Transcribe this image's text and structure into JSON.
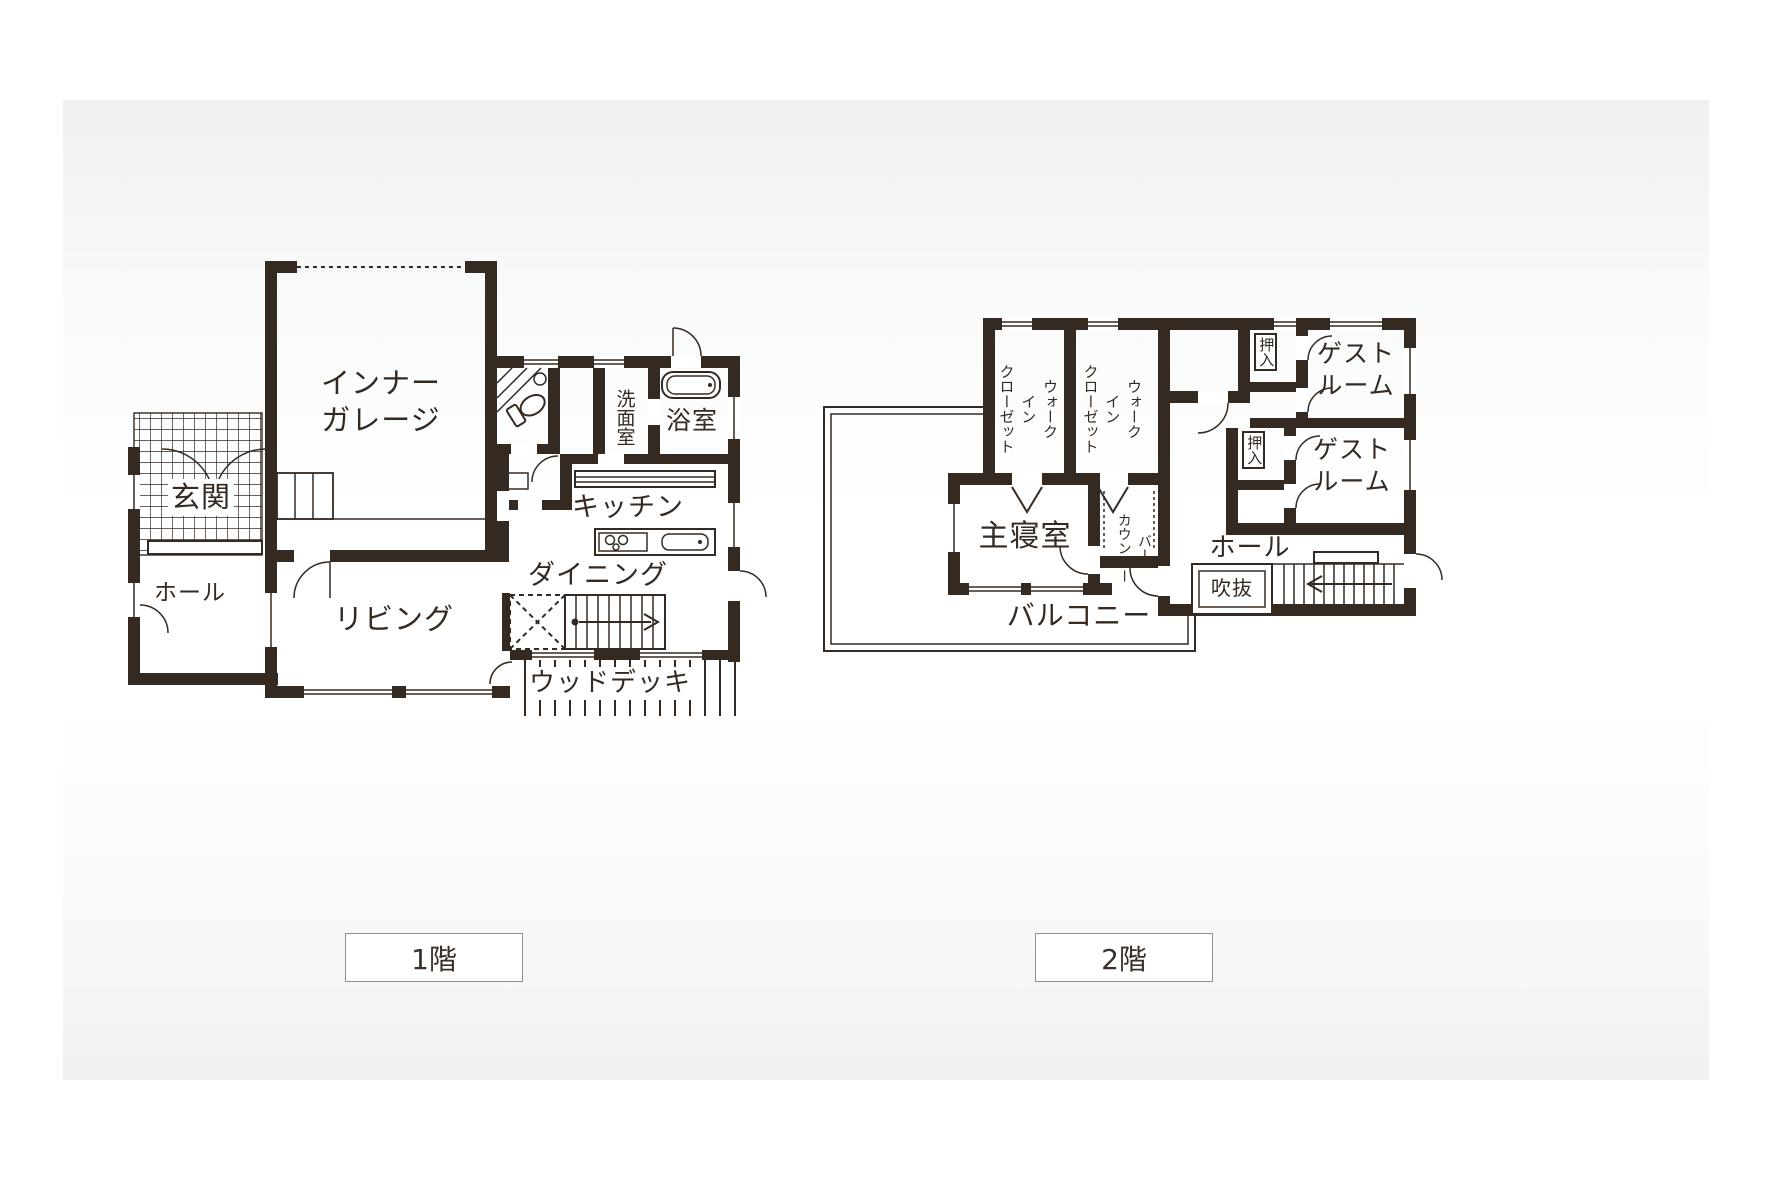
{
  "page": {
    "ink": "#352a21",
    "caption_border": "#8f8f8f"
  },
  "floor1": {
    "caption": "1階",
    "rooms": {
      "garage": "インナー\nガレージ",
      "genkan": "玄関",
      "hall": "ホール",
      "living": "リビング",
      "kitchen": "キッチン",
      "dining": "ダイニング",
      "washroom": "洗面室",
      "bathroom": "浴室",
      "deck": "ウッドデッキ"
    }
  },
  "floor2": {
    "caption": "2階",
    "rooms": {
      "wic1": "ウォーク\nイン\nクローゼット",
      "wic2": "ウォーク\nイン\nクローゼット",
      "oshiire1": "押入",
      "oshiire2": "押入",
      "guest1": "ゲスト\nルーム",
      "guest2": "ゲスト\nルーム",
      "master": "主寝室",
      "bar": "バー\nカウンター",
      "hall": "ホール",
      "void": "吹抜",
      "balcony": "バルコニー"
    }
  }
}
